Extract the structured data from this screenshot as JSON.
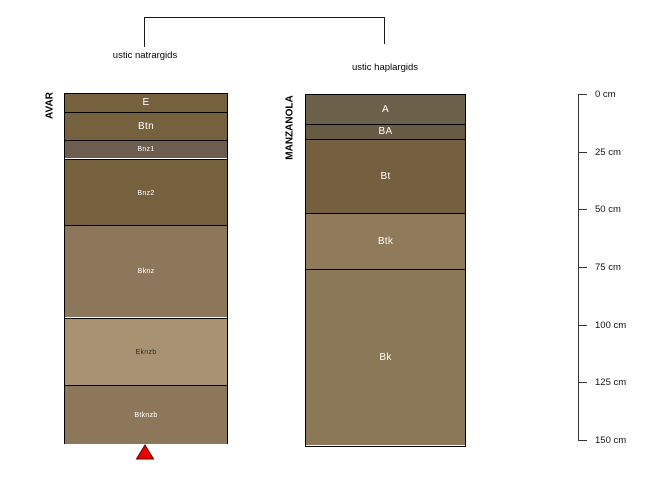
{
  "figure": {
    "background": "#ffffff",
    "classification_bracket": {
      "left_label": "ustic natrargids",
      "right_label": "ustic haplargids"
    },
    "profiles": [
      {
        "name": "AVAR",
        "great_group": "ustic natrargids",
        "horizons": [
          {
            "label": "E",
            "top_cm": 0,
            "bottom_cm": 8,
            "color": "#76613f",
            "label_color": "#ffffff"
          },
          {
            "label": "Btn",
            "top_cm": 8,
            "bottom_cm": 20,
            "color": "#76613f",
            "label_color": "#ffffff"
          },
          {
            "label": "Bnz1",
            "top_cm": 20,
            "bottom_cm": 28,
            "color": "#6c5d4e",
            "label_color": "#ffffff"
          },
          {
            "label": "Bnz2",
            "top_cm": 28,
            "bottom_cm": 57,
            "color": "#76613f",
            "label_color": "#ffffff"
          },
          {
            "label": "Bknz",
            "top_cm": 57,
            "bottom_cm": 97,
            "color": "#8d775a",
            "label_color": "#ffffff"
          },
          {
            "label": "Eknzb",
            "top_cm": 97,
            "bottom_cm": 126,
            "color": "#a99272",
            "label_color": "#2b2b2b"
          },
          {
            "label": "Btknzb",
            "top_cm": 126,
            "bottom_cm": 151.5,
            "color": "#8d775a",
            "label_color": "#ffffff"
          }
        ],
        "marker": {
          "symbol": "filled-triangle-up",
          "color": "#ee0000",
          "position": "below-profile-center"
        }
      },
      {
        "name": "MANZANOLA",
        "great_group": "ustic haplargids",
        "horizons": [
          {
            "label": "A",
            "top_cm": 0,
            "bottom_cm": 12.5,
            "color": "#6b6049",
            "label_color": "#ffffff"
          },
          {
            "label": "BA",
            "top_cm": 12.5,
            "bottom_cm": 19,
            "color": "#675b44",
            "label_color": "#ffffff"
          },
          {
            "label": "Bt",
            "top_cm": 19,
            "bottom_cm": 51,
            "color": "#74603f",
            "label_color": "#ffffff"
          },
          {
            "label": "Btk",
            "top_cm": 51,
            "bottom_cm": 75.5,
            "color": "#8f7b59",
            "label_color": "#ffffff"
          },
          {
            "label": "Bk",
            "top_cm": 75.5,
            "bottom_cm": 152,
            "color": "#8a7857",
            "label_color": "#ffffff"
          }
        ]
      }
    ],
    "depth_axis": {
      "unit": "cm",
      "min_cm": 0,
      "max_cm": 150,
      "tick_interval_cm": 25,
      "tick_labels": [
        "0 cm",
        "25 cm",
        "50 cm",
        "75 cm",
        "100 cm",
        "125 cm",
        "150 cm"
      ]
    }
  }
}
